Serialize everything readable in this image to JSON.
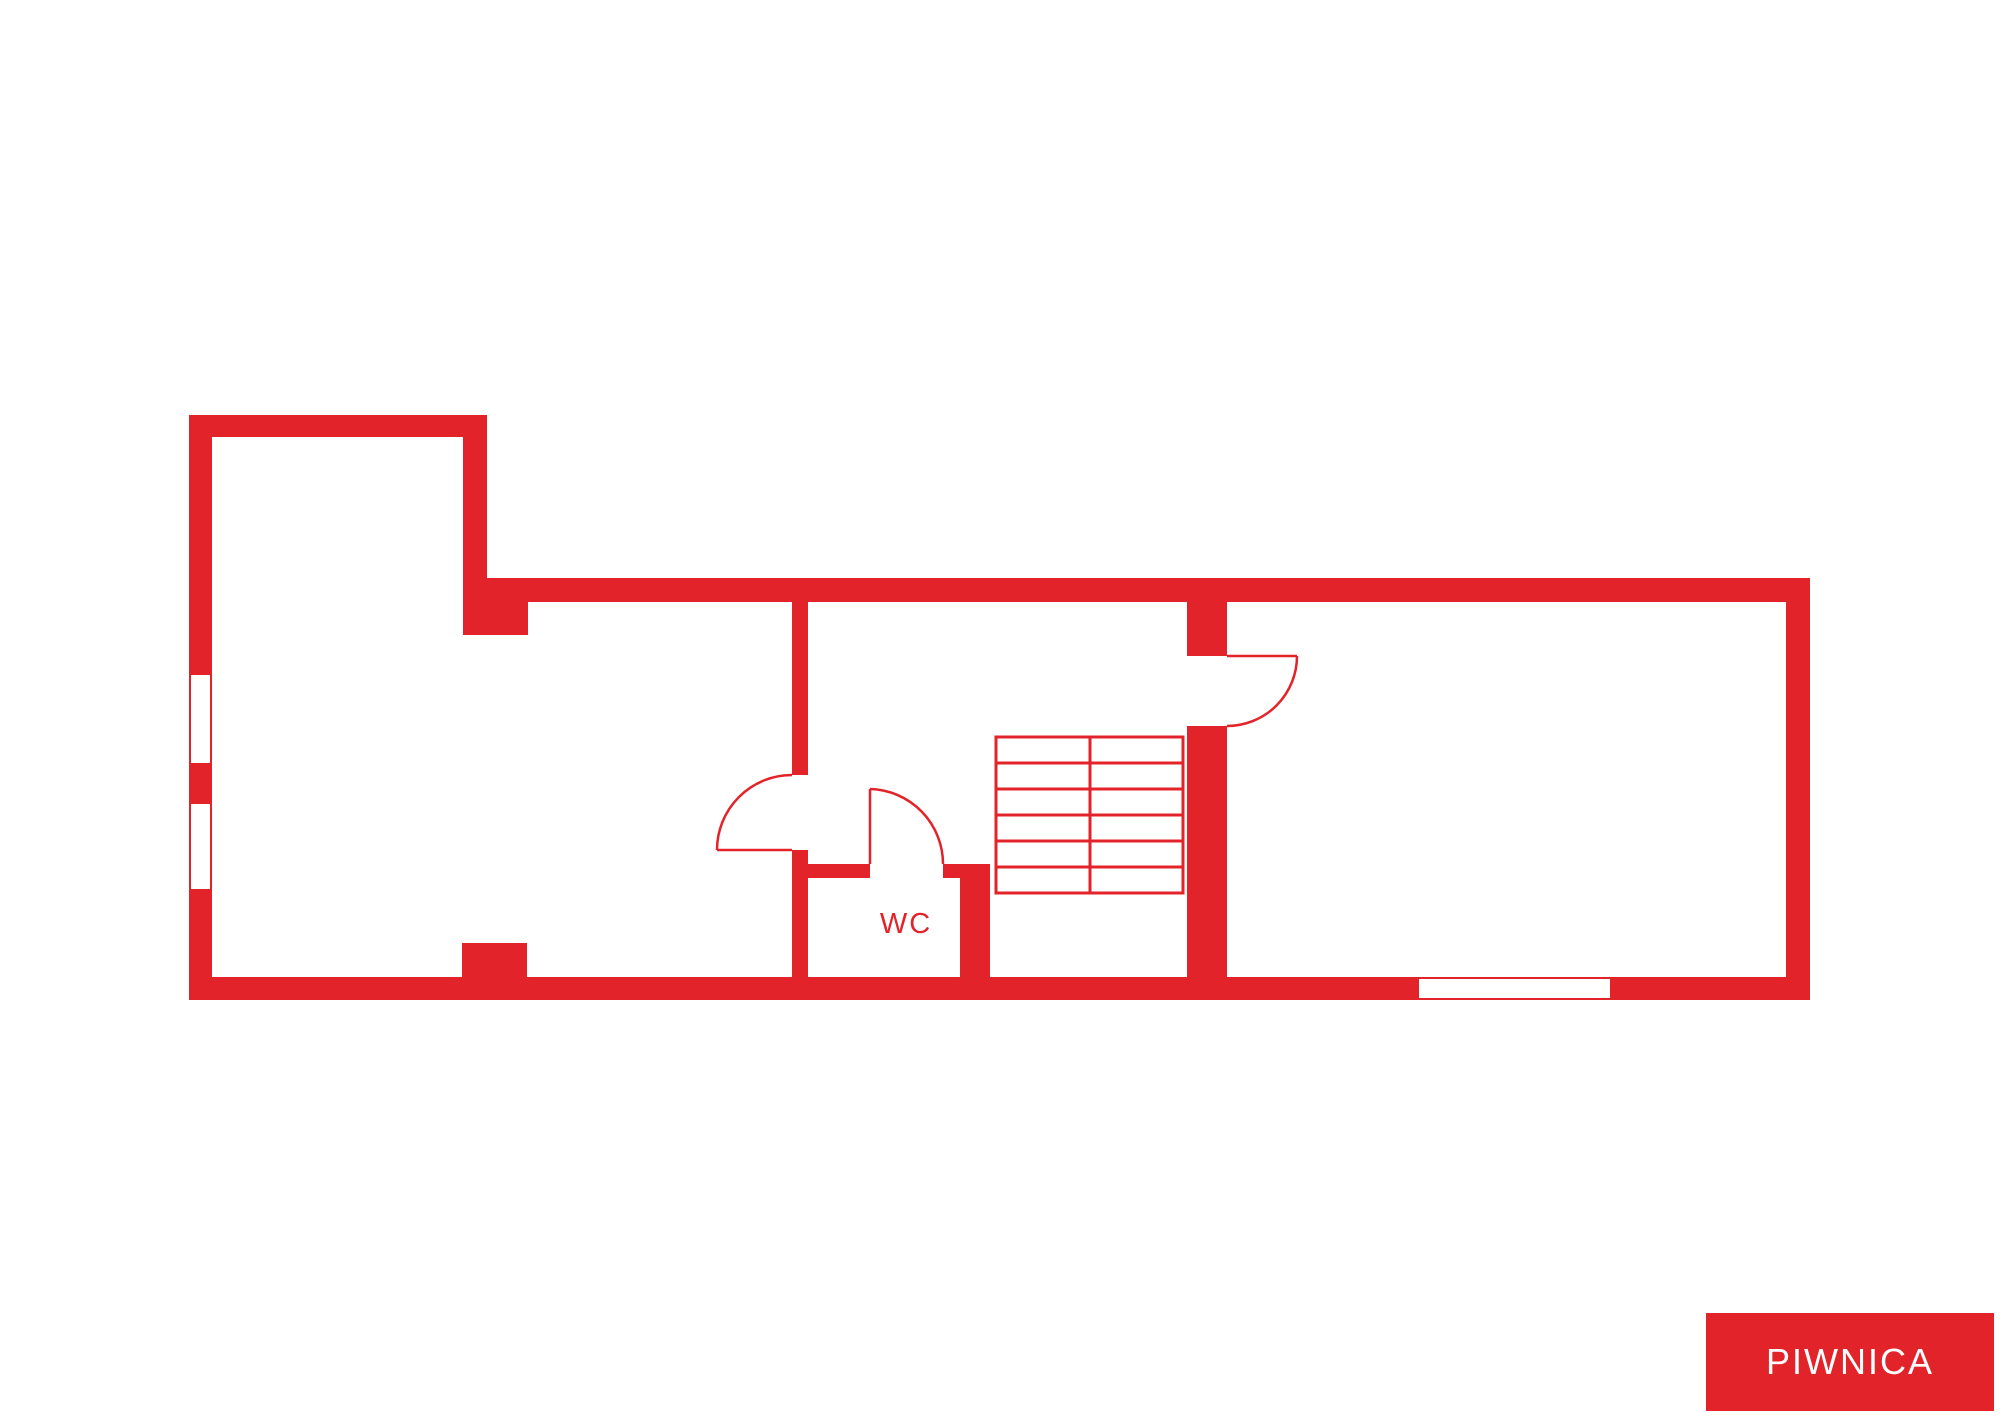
{
  "colors": {
    "wall": "#e3232a",
    "background": "#ffffff"
  },
  "labels": {
    "wc": "WC",
    "floor": "PIWNICA"
  },
  "plan": {
    "type": "basement-floor-plan",
    "door_arcs": 3,
    "windows": {
      "left_wall": 2,
      "bottom_wall": 1
    },
    "stairs": {
      "treads": 6,
      "columns": 2
    }
  }
}
